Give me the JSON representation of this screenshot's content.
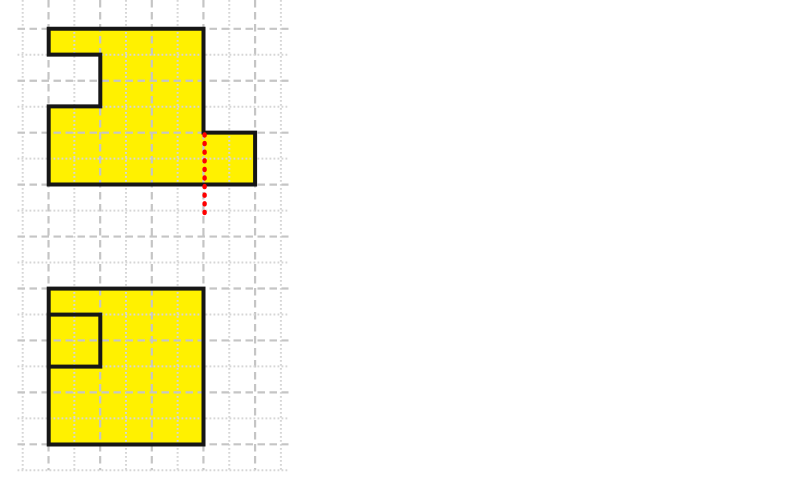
{
  "figure": {
    "canvas": {
      "width": 800,
      "height": 498,
      "background_color": "#ffffff"
    },
    "grid": {
      "columns": {
        "start_x": 22.7,
        "step": 25.82,
        "count": 11,
        "top": 0,
        "bottom": 470.3
      },
      "rows": {
        "start_y": 28.8,
        "step": 25.97,
        "count": 18,
        "left": 17.5,
        "right": 288.5
      },
      "major_style": {
        "color": "#c5c5c5",
        "width": 2.2,
        "dash": "7.5 4.5"
      },
      "minor_style": {
        "color": "#d6d6d6",
        "width": 2.0,
        "dash": "1.8 2.2"
      },
      "major_parity": {
        "columns": 1,
        "rows": 0
      }
    },
    "shape_style": {
      "fill": "#fff100",
      "stroke": "#161616",
      "stroke_width": 4
    },
    "folded_shape": {
      "points": [
        [
          48.7,
          28.8
        ],
        [
          203.5,
          28.8
        ],
        [
          203.5,
          132.6
        ],
        [
          255.1,
          132.6
        ],
        [
          255.1,
          184.5
        ],
        [
          48.7,
          184.5
        ],
        [
          48.7,
          106.4
        ],
        [
          100.3,
          106.4
        ],
        [
          100.3,
          54.6
        ],
        [
          48.7,
          54.6
        ]
      ]
    },
    "unfolded_square": {
      "x": 48.7,
      "y": 288.6,
      "width": 154.8,
      "height": 155.9
    },
    "flap_outline": {
      "x": 48.7,
      "y": 314.6,
      "width": 51.6,
      "height": 52.0
    },
    "fold_line": {
      "x": 204.6,
      "y1": 134.5,
      "y2": 219.0,
      "color": "#fe0000",
      "width": 4.4,
      "dash": "1 7.6"
    }
  }
}
